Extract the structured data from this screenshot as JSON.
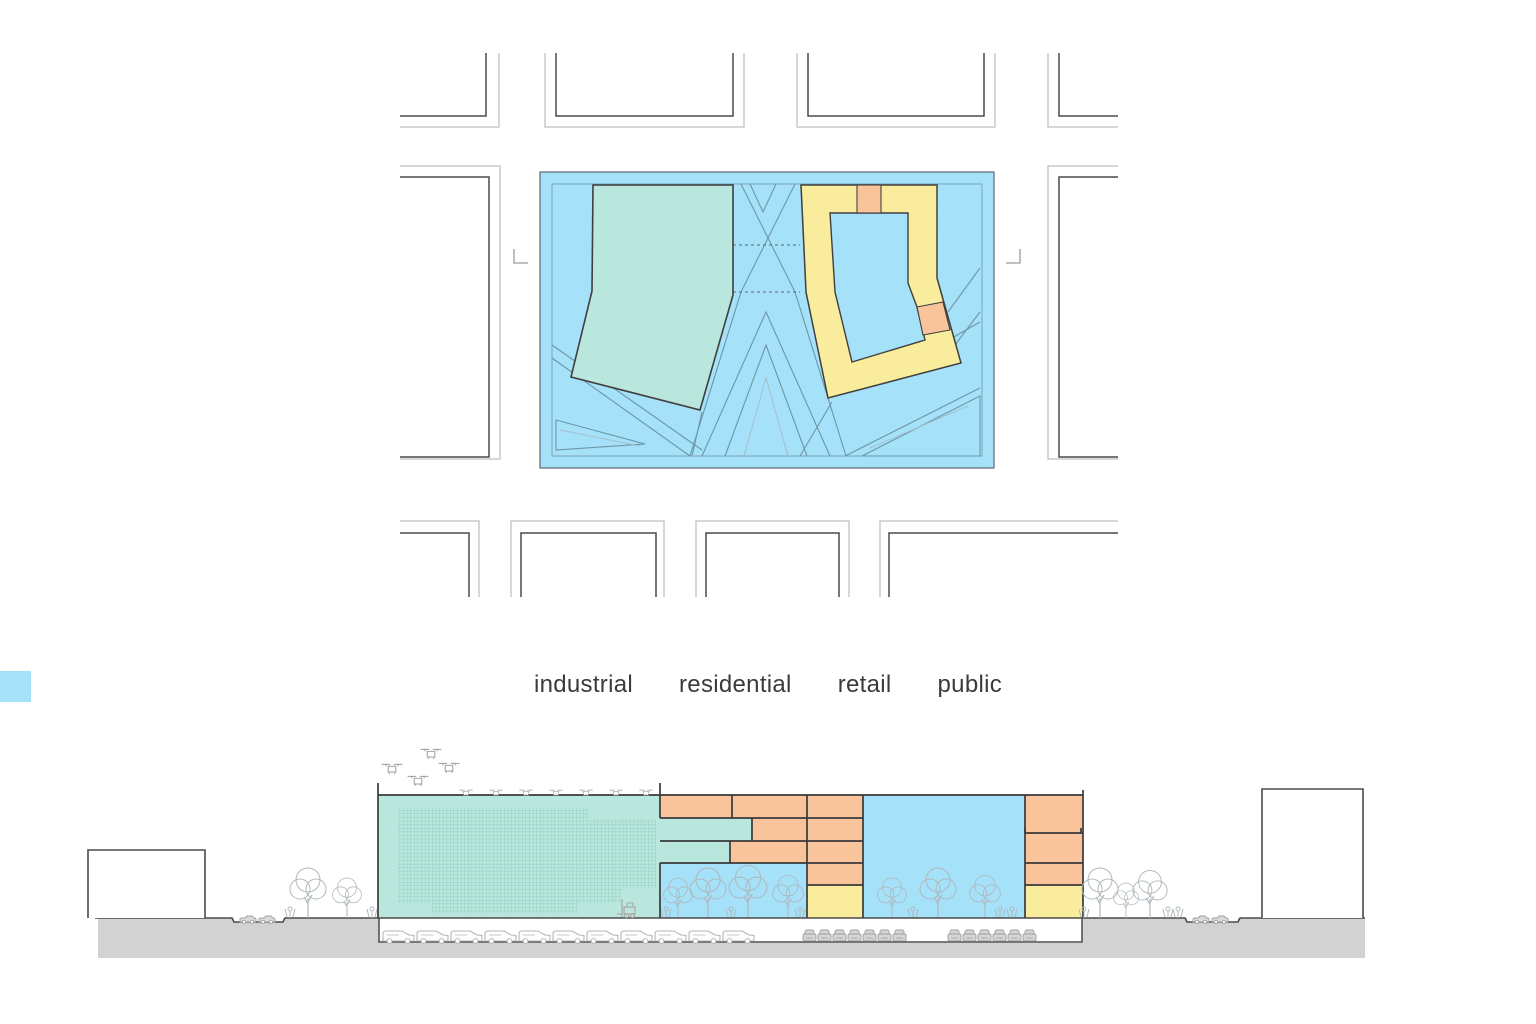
{
  "legend": {
    "items": [
      {
        "label": "industrial",
        "color": "#b9e7dd"
      },
      {
        "label": "residential",
        "color": "#f9c39c"
      },
      {
        "label": "retail",
        "color": "#f9ec9c"
      },
      {
        "label": "public",
        "color": "#a5e1f8"
      }
    ]
  },
  "colors": {
    "industrial": "#b9e7dd",
    "residential": "#f9c39c",
    "retail": "#f9ec9c",
    "public": "#a5e1f8",
    "ground": "#d2d2d2",
    "outline": "#3f3f3f",
    "sketch": "#b3b3b3",
    "path_line": "#6d96a8"
  }
}
